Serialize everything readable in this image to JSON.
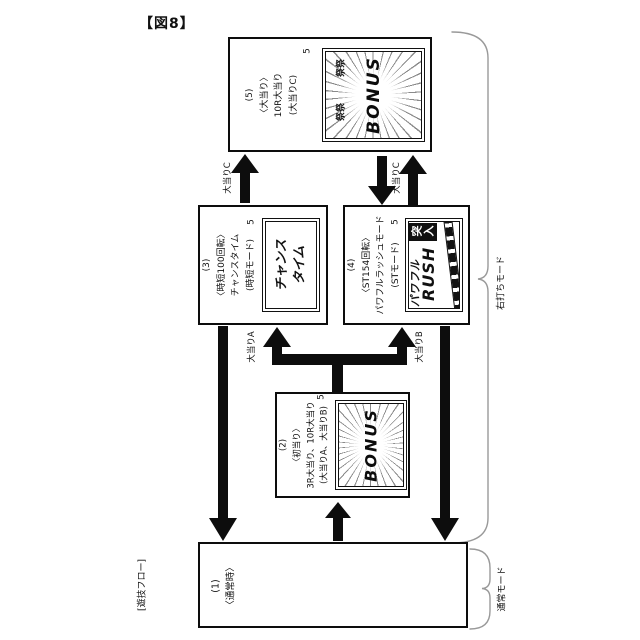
{
  "figure": {
    "label": "【図8】",
    "flow_label": "[遊技フロー]"
  },
  "boxes": {
    "b1": {
      "lines": [
        "(1)",
        "〈通常時〉"
      ]
    },
    "b2": {
      "lines": [
        "(2)",
        "〈初当り〉",
        "3R大当り、10R大当り",
        "(大当りA、大当りB)"
      ],
      "screen": {
        "ref": "5",
        "title": "BONUS"
      }
    },
    "b3": {
      "lines": [
        "(3)",
        "〈時短100回転〉",
        "チャンスタイム",
        "(時短モード)"
      ],
      "screen": {
        "ref": "5",
        "line1": "チャンス",
        "line2": "タイム"
      }
    },
    "b4": {
      "lines": [
        "(4)",
        "〈ST154回転〉",
        "パワフルラッシュモード",
        "(STモード)"
      ],
      "screen": {
        "ref": "5",
        "line1": "パワフル",
        "line2": "RUSH",
        "badge": "突入"
      }
    },
    "b5": {
      "lines": [
        "(5)",
        "〈大当り〉",
        "10R大当り",
        "(大当りC)"
      ],
      "screen": {
        "ref": "5",
        "title": "BONUS",
        "decor1": "祭祭",
        "decor2": "祭祭"
      }
    }
  },
  "arrow_labels": {
    "c_left": "大当りC",
    "c_right": "大当りC",
    "a": "大当りA",
    "b": "大当りB"
  },
  "side_labels": {
    "right_mode": "右打ちモード",
    "normal_mode": "通常モード"
  },
  "colors": {
    "line": "#0d0d0d",
    "brace": "#999999",
    "background": "#ffffff"
  }
}
